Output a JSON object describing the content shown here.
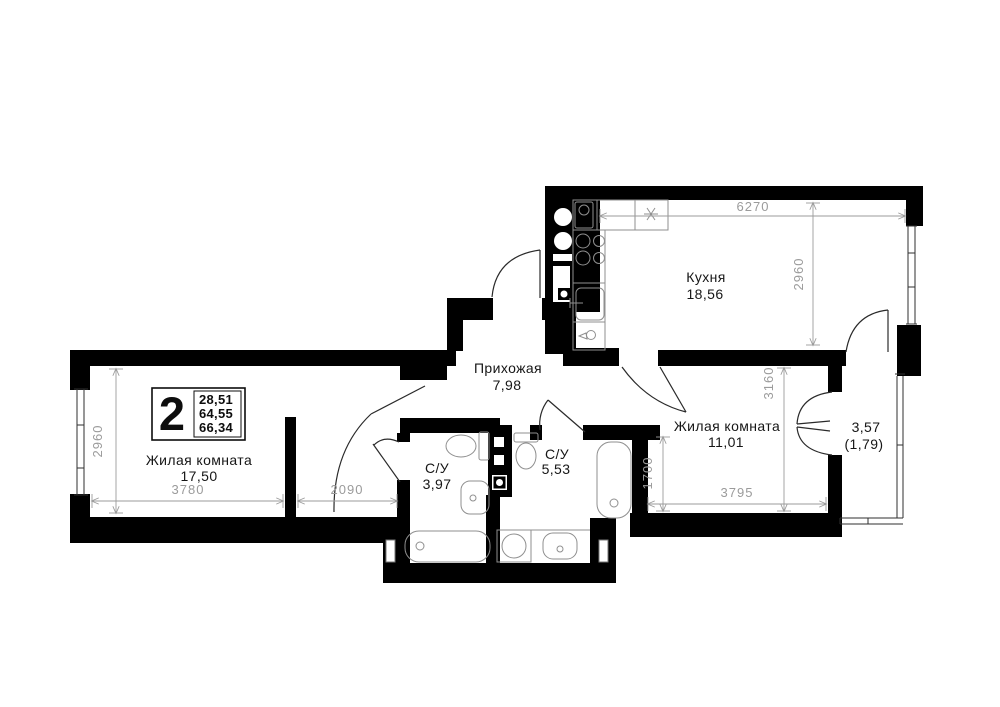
{
  "meta": {
    "background": "#ffffff",
    "wall_color": "#000000",
    "dim_color": "#9b9b9b",
    "label_color": "#161616",
    "plan_type": "apartment-floor-plan"
  },
  "legend": {
    "rooms_count": "2",
    "areas": [
      "28,51",
      "64,55",
      "66,34"
    ]
  },
  "rooms": {
    "kitchen": {
      "name": "Кухня",
      "area": "18,56"
    },
    "hallway": {
      "name": "Прихожая",
      "area": "7,98"
    },
    "living1": {
      "name": "Жилая комната",
      "area": "17,50"
    },
    "living2": {
      "name": "Жилая комната",
      "area": "11,01"
    },
    "bath1": {
      "name": "С/У",
      "area": "3,97"
    },
    "bath2": {
      "name": "С/У",
      "area": "5,53"
    },
    "balcony": {
      "area": "3,57",
      "area_reduced": "(1,79)"
    }
  },
  "dimensions": {
    "kitchen_width": "6270",
    "kitchen_depth": "2960",
    "living1_width": "3780",
    "living1_depth": "2960",
    "alcove_width": "2090",
    "living2_width": "3795",
    "living2_inner_depth": "1700",
    "living2_full_depth": "3160"
  }
}
